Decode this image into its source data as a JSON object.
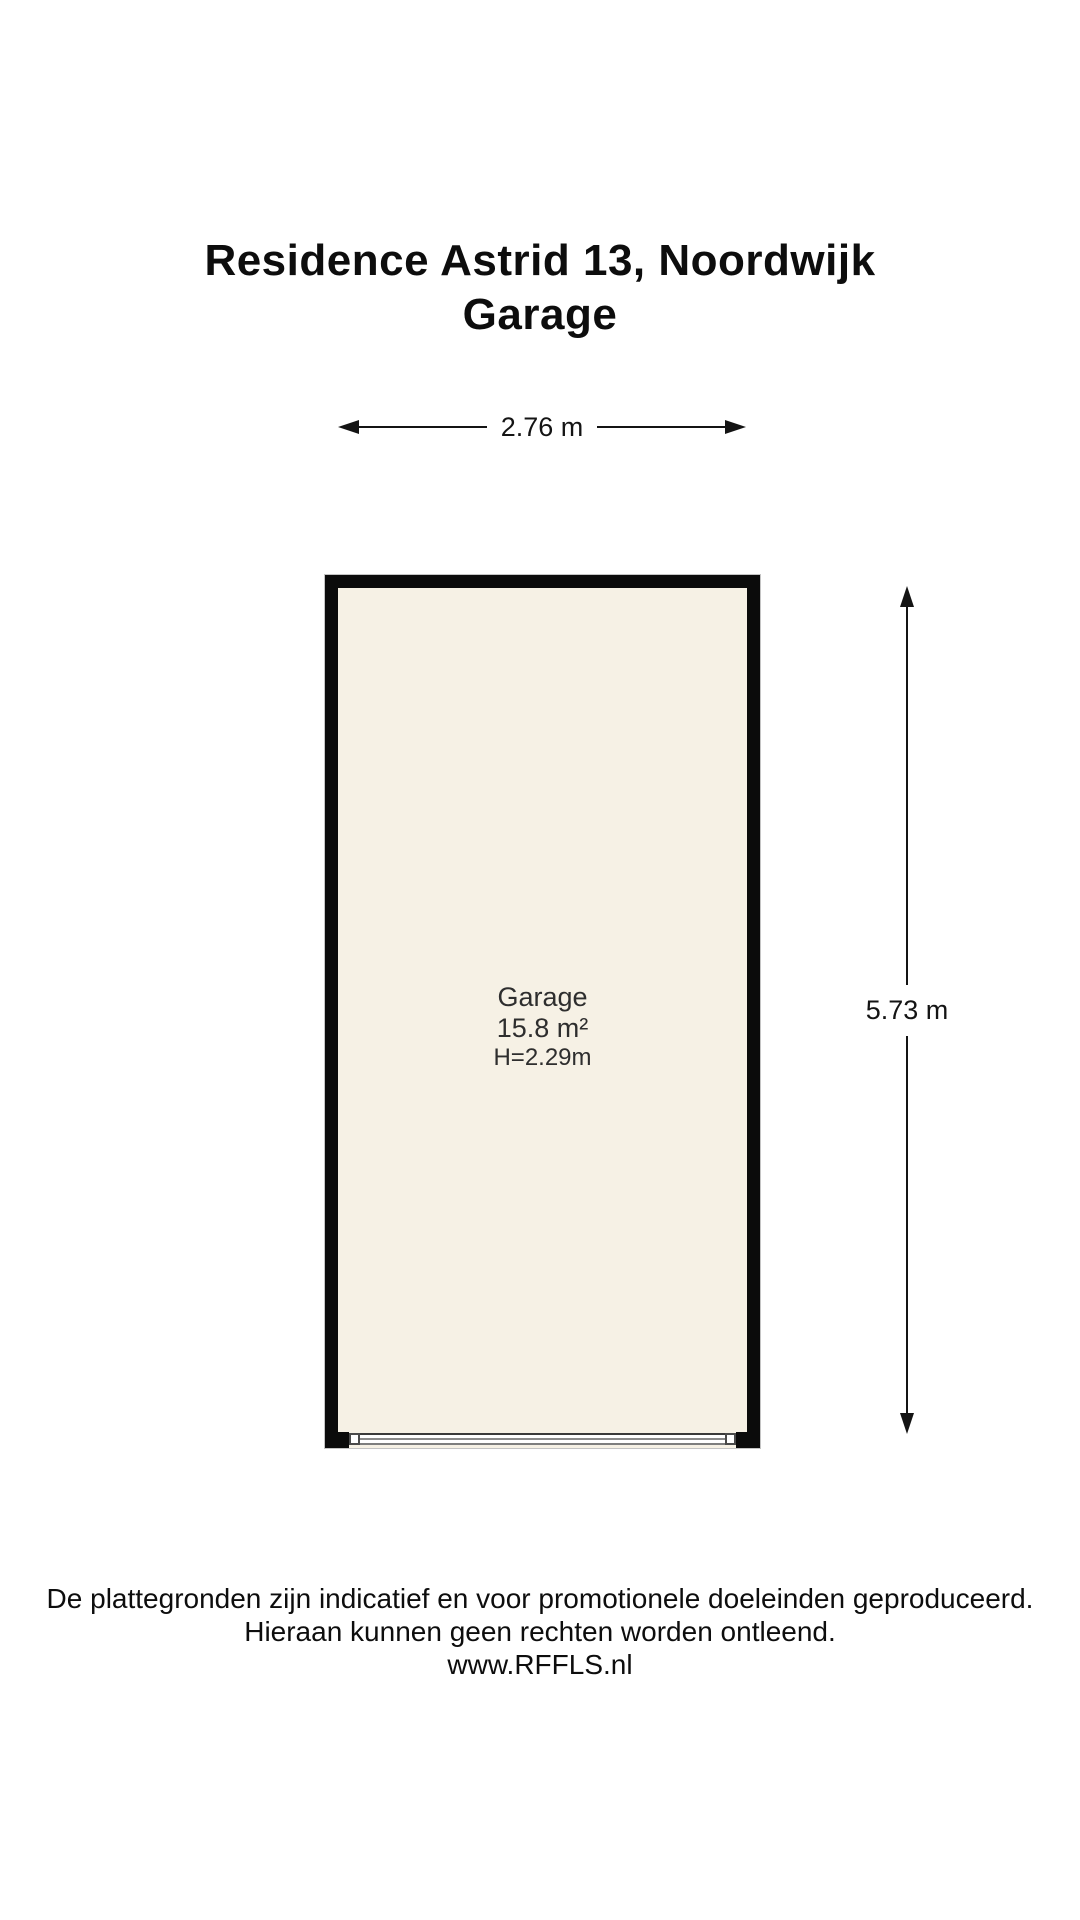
{
  "title": {
    "line1": "Residence Astrid 13, Noordwijk",
    "line2": "Garage"
  },
  "floorplan": {
    "room": {
      "name": "Garage",
      "area": "15.8 m²",
      "ceiling_height": "H=2.29m"
    },
    "dimensions": {
      "width": "2.76 m",
      "height": "5.73 m"
    },
    "colors": {
      "wall": "#0b0b0b",
      "floor": "#f6f1e5",
      "line": "#141414"
    }
  },
  "footer": {
    "line1": "De plattegronden zijn indicatief en voor promotionele doeleinden geproduceerd.",
    "line2": "Hieraan kunnen geen rechten worden ontleend.",
    "line3": "www.RFFLS.nl"
  }
}
